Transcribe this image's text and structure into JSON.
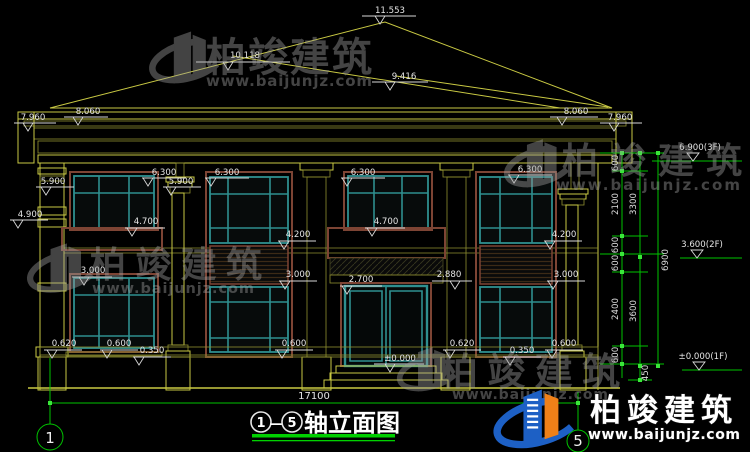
{
  "title": {
    "axis_from": "1",
    "axis_to": "5",
    "dash": "—",
    "label": "轴立面图"
  },
  "axis_bubbles": {
    "left": "1",
    "right": "5"
  },
  "total_width_dim": "17100",
  "roof": {
    "ridge": "11.553",
    "hip_left": "10.118",
    "hip_right": "9.416",
    "eave_upper_left": "8.060",
    "eave_lower_left": "7.960",
    "eave_upper_right": "8.060",
    "eave_lower_right": "7.960"
  },
  "levels": {
    "f3": "6.900(3F)",
    "f2": "3.600(2F)",
    "f1": "±0.000(1F)"
  },
  "marks": {
    "win_top_1": "6.300",
    "win_top_2": "6.300",
    "win_top_3": "6.300",
    "win_top_4": "6.300",
    "cap_1": "5.900",
    "cap_2": "5.900",
    "band_left": "4.900",
    "rail_1": "4.700",
    "rail_2": "4.700",
    "sill2f_1": "4.200",
    "sill2f_2": "4.200",
    "slab_1": "3.000",
    "slab_2": "3.000",
    "slab_3": "3.000",
    "door_top": "2.700",
    "beam": "2.880",
    "door_base": "±0.000",
    "plinth_1": "0.620",
    "plinth_2": "0.620",
    "sill1f_1": "0.600",
    "sill1f_2": "0.600",
    "sill1f_3": "0.600",
    "base_1": "0.350",
    "base_2": "0.350"
  },
  "dims_right": {
    "a1": "600",
    "a2": "2100",
    "a3": "600",
    "a4": "600",
    "a5": "2400",
    "a6": "600",
    "b1": "3300",
    "b2": "3600",
    "b3": "450",
    "c1": "6900"
  },
  "watermark": {
    "brand": "柏竣建筑",
    "url": "www.baijunjz.com"
  },
  "logo": {
    "brand": "柏竣建筑",
    "url": "www.baijunjz.com"
  }
}
